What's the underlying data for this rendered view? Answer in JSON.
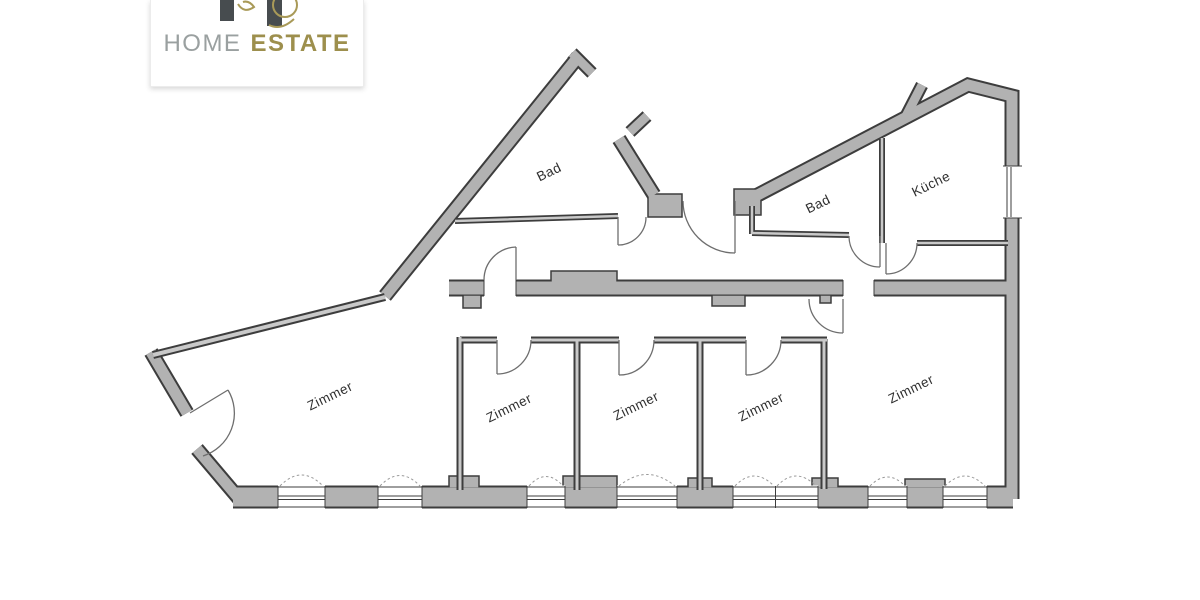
{
  "logo": {
    "home": "HOME",
    "estate": "ESTATE"
  },
  "colors": {
    "logo_home": "#9aa0a0",
    "logo_estate": "#9d8f4d",
    "logo_mark_dark": "#474c4f",
    "logo_mark_gold": "#a99a58",
    "wall_fill": "#b2b2b2",
    "wall_outline": "#3d3d3d",
    "thin_wall_core": "#c9c9c9",
    "door_arc": "#6e6e6e",
    "window_dash": "#9a9a9a",
    "label_text": "#2f2f2f",
    "background": "#ffffff"
  },
  "floorplan": {
    "rooms": {
      "bad_top": {
        "label": "Bad"
      },
      "bad_right": {
        "label": "Bad"
      },
      "kueche": {
        "label": "Küche"
      },
      "zimmer_left": {
        "label": "Zimmer"
      },
      "zimmer_mid1": {
        "label": "Zimmer"
      },
      "zimmer_mid2": {
        "label": "Zimmer"
      },
      "zimmer_mid3": {
        "label": "Zimmer"
      },
      "zimmer_right": {
        "label": "Zimmer"
      }
    }
  }
}
